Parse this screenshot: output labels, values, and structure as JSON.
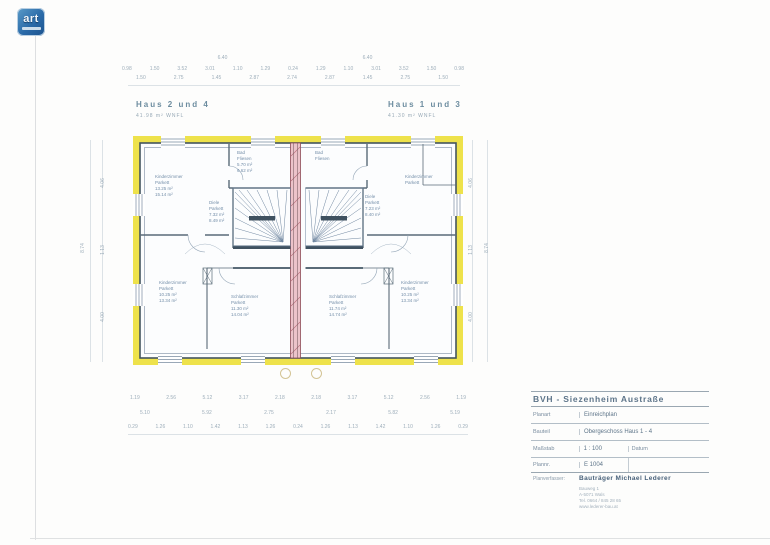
{
  "logo": {
    "text": "art"
  },
  "plan_titles": {
    "left_title": "Haus 2 und 4",
    "left_subtitle": "41.98 m² WNFL",
    "right_title": "Haus 1 und 3",
    "right_subtitle": "41.30 m² WNFL",
    "handwritten_note": "BAD"
  },
  "rooms": {
    "left_top": {
      "name": "Kinderzimmer",
      "floor": "Parkett",
      "area1": "13.25 m²",
      "area2": "15.14 m²"
    },
    "left_bad": {
      "name": "Bad",
      "floor": "Fliesen",
      "area1": "5.70 m²",
      "area2": "6.62 m²"
    },
    "left_diele": {
      "name": "Diele",
      "floor": "Parkett",
      "area1": "7.32 m²",
      "area2": "8.49 m²"
    },
    "left_kinder": {
      "name": "Kinderzimmer",
      "floor": "Parkett",
      "area1": "10.25 m²",
      "area2": "13.34 m²"
    },
    "left_schlaf": {
      "name": "Schlafzimmer",
      "floor": "Parkett",
      "area1": "11.30 m²",
      "area2": "14.04 m²"
    },
    "right_bad": {
      "name": "Bad",
      "floor": "Fliesen",
      "area1": "5.70 m²",
      "area2": "6.62 m²"
    },
    "right_top": {
      "name": "Kinderzimmer",
      "floor": "Parkett",
      "area1": "13.25 m²",
      "area2": "15.14 m²"
    },
    "right_diele": {
      "name": "Diele",
      "floor": "Parkett",
      "area1": "7.23 m²",
      "area2": "8.40 m²"
    },
    "right_schlaf": {
      "name": "Schlafzimmer",
      "floor": "Parkett",
      "area1": "11.74 m²",
      "area2": "14.74 m²"
    },
    "right_kinder": {
      "name": "Kinderzimmer",
      "floor": "Parkett",
      "area1": "10.25 m²",
      "area2": "13.34 m²"
    }
  },
  "dims": {
    "top_span": [
      "6.40",
      "6.40"
    ],
    "top_row1": [
      "0.98",
      "1.50",
      "3.52",
      "3.01",
      "1.10",
      "1.29",
      "0.24",
      "1.29",
      "1.10",
      "3.01",
      "3.52",
      "1.50",
      "0.98"
    ],
    "top_row2": [
      "1.50",
      "2.75",
      "1.45",
      "2.87",
      "2.74",
      "2.87",
      "1.45",
      "2.75",
      "1.50"
    ],
    "bottom_row1": [
      "1.19",
      "2.56",
      "5.12",
      "3.17",
      "2.18",
      "2.18",
      "3.17",
      "5.12",
      "2.56",
      "1.19"
    ],
    "bottom_row2": [
      "5.10",
      "5.92",
      "2.75",
      "2.17",
      "5.82",
      "5.19"
    ],
    "bottom_row3": [
      "0.29",
      "1.26",
      "1.10",
      "1.42",
      "1.13",
      "1.26",
      "0.24",
      "1.26",
      "1.13",
      "1.42",
      "1.10",
      "1.26",
      "0.29"
    ],
    "left_outer": "8.74",
    "left_inner": [
      "4.06",
      "1.13",
      "4.00"
    ],
    "right_inner": [
      "4.06",
      "1.13",
      "4.00"
    ],
    "right_outer": "8.74"
  },
  "titleblock": {
    "project": "BVH - Siezenheim Austraße",
    "planart_label": "Planart",
    "planart_value": "Einreichplan",
    "bauteil_label": "Bauteil",
    "bauteil_value": "Obergeschoss Haus 1 - 4",
    "massstab_label": "Maßstab",
    "massstab_value": "1 : 100",
    "datum_label": "Datum",
    "datum_value": "",
    "plannr_label": "Plannr.",
    "plannr_value": "E 1004",
    "verfasser_label": "Planverfasser:",
    "verfasser_value": "Bauträger  Michael Lederer",
    "address_lines": [
      "Bauweg 1",
      "A-5071 Wals",
      "Tel. 0664 / 845 28 65",
      "www.lederer-bau.at"
    ]
  }
}
